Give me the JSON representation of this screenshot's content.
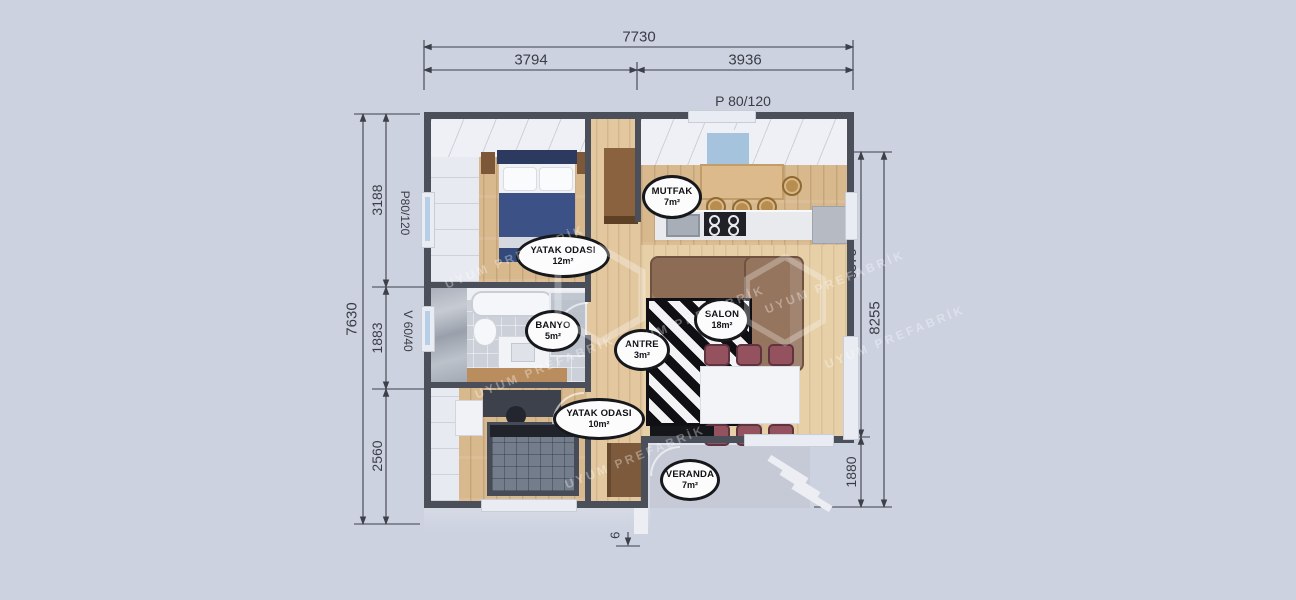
{
  "plan": {
    "watermark": "UYUM PREFABRİK",
    "rooms": {
      "mutfak": {
        "name": "MUTFAK",
        "area": "7m²"
      },
      "yatak1": {
        "name": "YATAK ODASI",
        "area": "12m²"
      },
      "banyo": {
        "name": "BANYO",
        "area": "5m²"
      },
      "antre": {
        "name": "ANTRE",
        "area": "3m²"
      },
      "salon": {
        "name": "SALON",
        "area": "18m²"
      },
      "yatak2": {
        "name": "YATAK ODASI",
        "area": "10m²"
      },
      "veranda": {
        "name": "VERANDA",
        "area": "7m²"
      }
    }
  },
  "dimensions": {
    "top": {
      "total": "7730",
      "seg_left": "3794",
      "seg_right": "3936",
      "window": "P 80/120"
    },
    "left": {
      "total": "7630",
      "seg_top": "3188",
      "seg_mid": "1883",
      "seg_bottom": "2560",
      "window_top": "P80/120",
      "window_mid": "V 60/40"
    },
    "right": {
      "seg_top": "6375",
      "seg_bottom": "1880",
      "total": "8255",
      "window": "P 80/120"
    },
    "bottom": {
      "door_left": "P2 160/120",
      "step": "625",
      "door_right": "P2 160/120"
    }
  },
  "colors": {
    "background": "#cdd2e1",
    "wall": "#4b4f5a",
    "dimension_text": "#3a3d45",
    "badge_border": "#17181c",
    "wood_floor": "#d8b98e",
    "duvet_blue": "#3c5286",
    "sofa_brown": "#8d6c56",
    "chair_maroon": "#94525f"
  }
}
